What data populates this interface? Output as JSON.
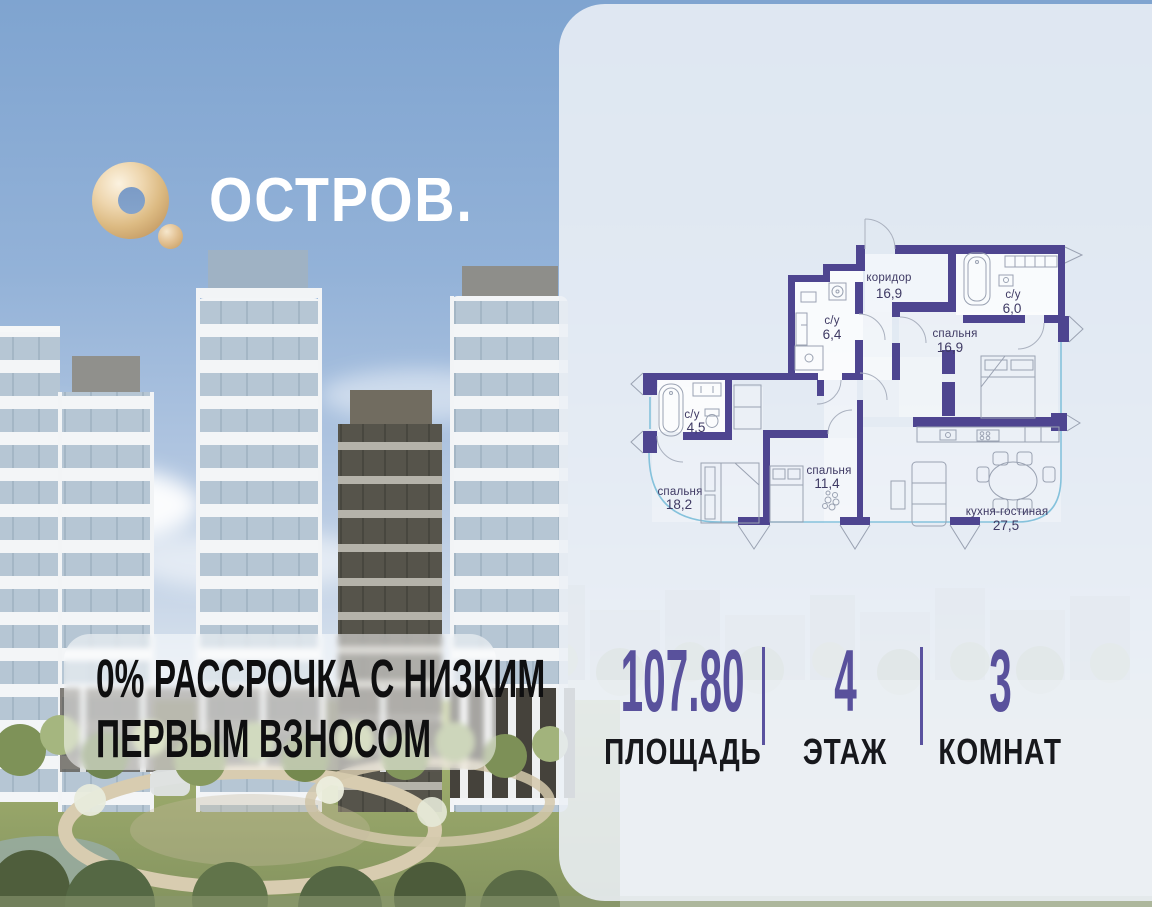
{
  "logo": {
    "brand": "ОСТРОВ."
  },
  "promo": {
    "line1": "0% РАССРОЧКА С НИЗКИМ",
    "line2": "ПЕРВЫМ ВЗНОСОМ"
  },
  "plan": {
    "rooms": [
      {
        "name": "коридор",
        "area": "16,9"
      },
      {
        "name": "с/у",
        "area": "6,4"
      },
      {
        "name": "с/у",
        "area": "6,0"
      },
      {
        "name": "спальня",
        "area": "16,9"
      },
      {
        "name": "с/у",
        "area": "4,5"
      },
      {
        "name": "спальня",
        "area": "18,2"
      },
      {
        "name": "спальня",
        "area": "11,4"
      },
      {
        "name": "кухня-гостиная",
        "area": "27,5"
      }
    ]
  },
  "stats": [
    {
      "value": "107.80",
      "label": "ПЛОЩАДЬ"
    },
    {
      "value": "4",
      "label": "ЭТАЖ"
    },
    {
      "value": "3",
      "label": "КОМНАТ"
    }
  ],
  "colors": {
    "accent_purple": "#59519C",
    "wall_purple": "#4E4590",
    "logo_gold": "#E3C496",
    "facade_blue": "#85C2DC"
  }
}
